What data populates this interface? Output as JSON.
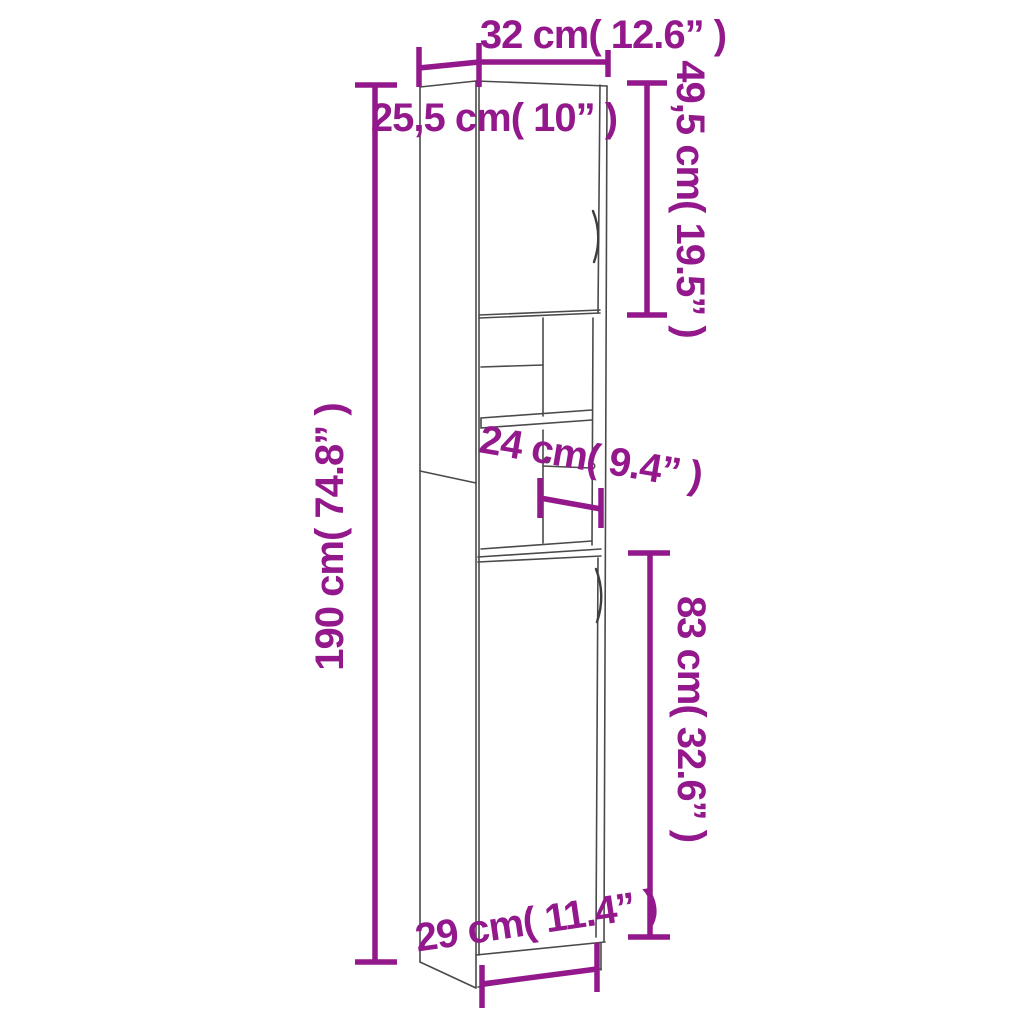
{
  "diagram": {
    "title": "tall-bathroom-cabinet-dimension-diagram",
    "background_color": "#ffffff",
    "accent_color": "#93188c",
    "outline_color": "#4a4a4a",
    "dimensions": {
      "top_width": "32 cm( 12.6” )",
      "top_depth": "25,5 cm( 10” )",
      "upper_door_height": "49,5 cm( 19.5” )",
      "total_height": "190 cm( 74.8” )",
      "inner_shelf_depth": "24 cm( 9.4” )",
      "lower_door_height": "83 cm( 32.6” )",
      "bottom_width": "29 cm( 11.4” )"
    }
  }
}
